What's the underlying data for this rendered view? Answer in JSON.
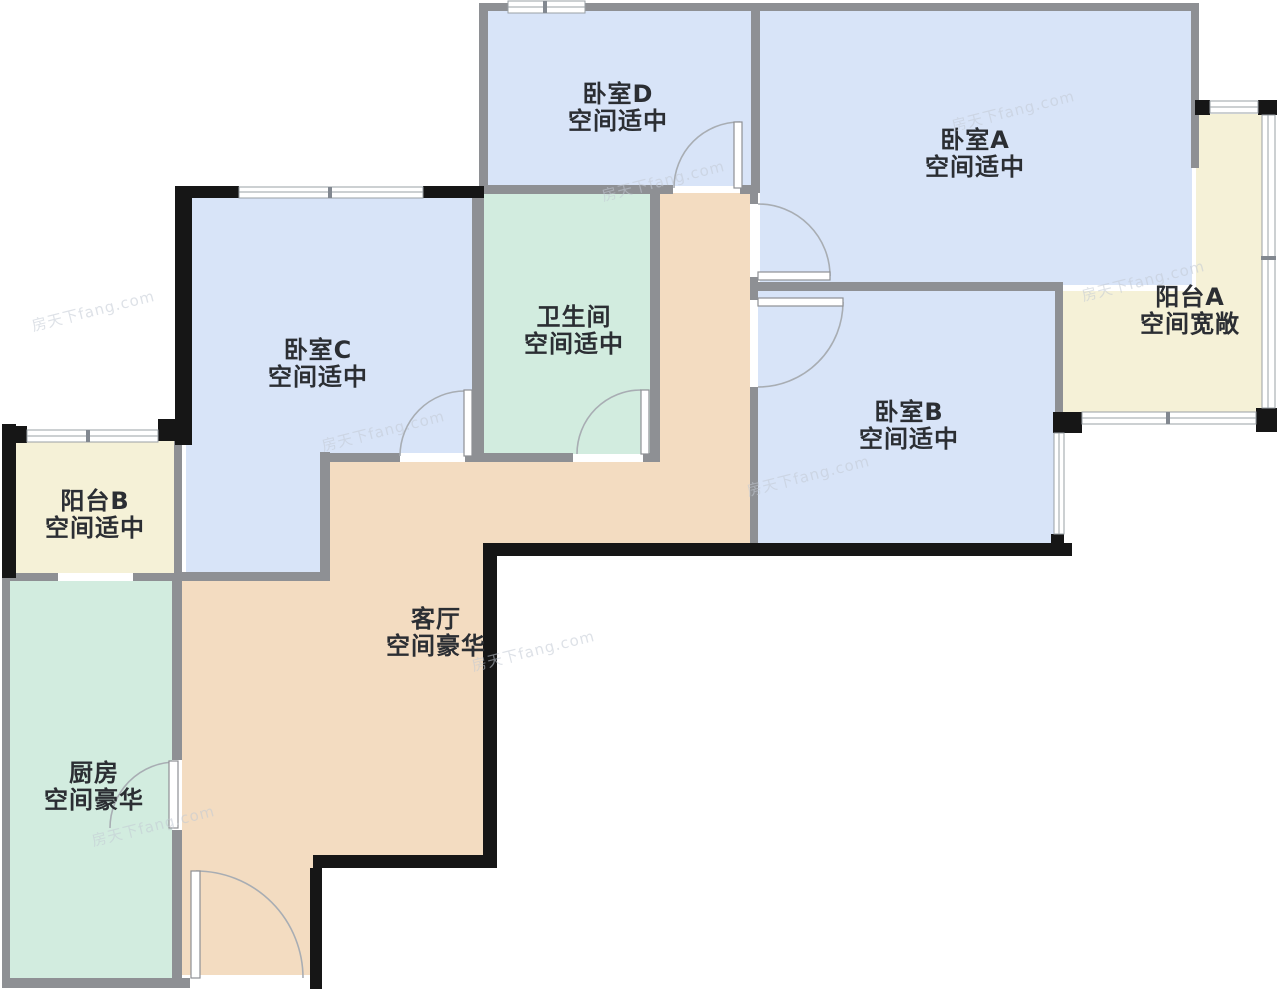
{
  "floorplan": {
    "rooms": [
      {
        "id": "bedroom-d",
        "name": "卧室D",
        "note": "空间适中"
      },
      {
        "id": "bedroom-a",
        "name": "卧室A",
        "note": "空间适中"
      },
      {
        "id": "balcony-a",
        "name": "阳台A",
        "note": "空间宽敞"
      },
      {
        "id": "bedroom-c",
        "name": "卧室C",
        "note": "空间适中"
      },
      {
        "id": "bathroom",
        "name": "卫生间",
        "note": "空间适中"
      },
      {
        "id": "bedroom-b",
        "name": "卧室B",
        "note": "空间适中"
      },
      {
        "id": "balcony-b",
        "name": "阳台B",
        "note": "空间适中"
      },
      {
        "id": "living-room",
        "name": "客厅",
        "note": "空间豪华"
      },
      {
        "id": "kitchen",
        "name": "厨房",
        "note": "空间豪华"
      }
    ],
    "watermark_text": "房天下fang.com",
    "colors": {
      "room_blue": "#d8e4f8",
      "room_mint": "#d2ecdf",
      "room_cream": "#f5f1d7",
      "room_peach": "#f3dcc1",
      "wall_gray": "#8e9094",
      "wall_black": "#161616",
      "line": "#9aa0a6",
      "label": "#2b2e33",
      "watermark": "#c3cad4",
      "background": "#ffffff"
    }
  }
}
